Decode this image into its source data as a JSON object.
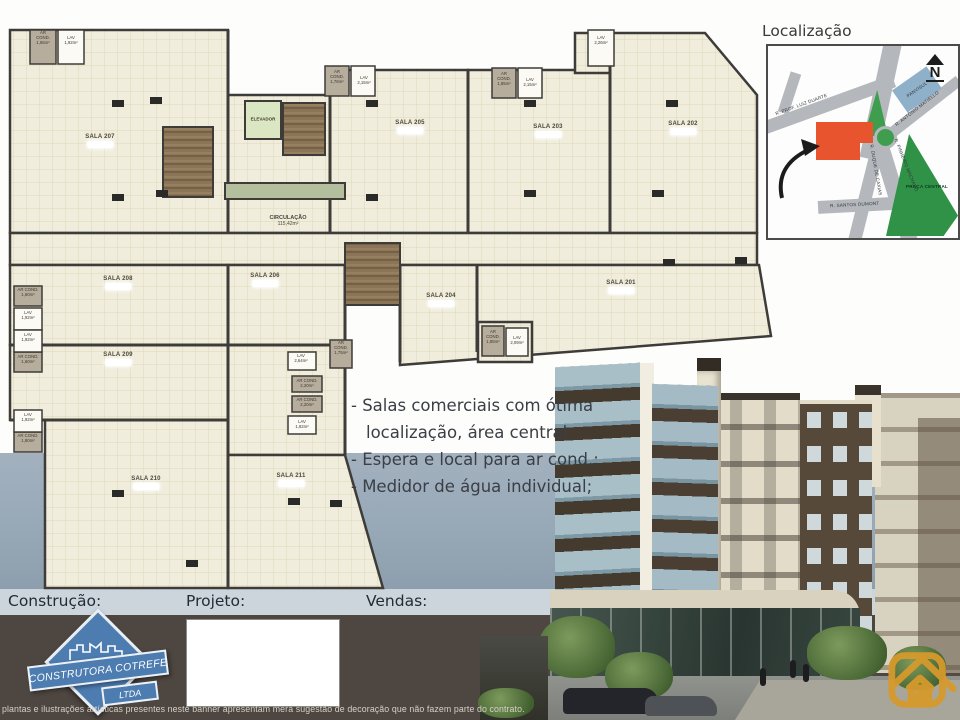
{
  "banner": {
    "bullets": [
      "- Salas comerciais com ótima",
      "localização, área central;",
      "- Espera e local para ar cond.;",
      "- Medidor de água individual;"
    ]
  },
  "plan": {
    "rooms": [
      {
        "label": "SALA 207"
      },
      {
        "label": "SALA 205"
      },
      {
        "label": "SALA 203"
      },
      {
        "label": "SALA 202"
      },
      {
        "label": "SALA 208"
      },
      {
        "label": "SALA 206"
      },
      {
        "label": "SALA 204"
      },
      {
        "label": "SALA 201"
      },
      {
        "label": "SALA 209"
      },
      {
        "label": "SALA 210"
      },
      {
        "label": "SALA 211"
      }
    ],
    "elevator_label": "ELEVADOR",
    "circulation_label": "CIRCULAÇÃO",
    "circulation_area": "115,42m²",
    "small_labels": [
      {
        "text": "AR\nCOND.\n1,65m²"
      },
      {
        "text": "LAV\n1,92m²"
      },
      {
        "text": "AR\nCOND.\n1,76m²"
      },
      {
        "text": "LAV\n2,15m²"
      },
      {
        "text": "AR\nCOND.\n1,85m²"
      },
      {
        "text": "LAV\n2,15m²"
      },
      {
        "text": "LAV\n2,26m²"
      },
      {
        "text": "AR COND.\n1,60m²"
      },
      {
        "text": "LAV\n1,92m²"
      },
      {
        "text": "LAV\n1,92m²"
      },
      {
        "text": "AR COND.\n1,60m²"
      },
      {
        "text": "LAV\n1,92m²"
      },
      {
        "text": "AR COND.\n1,80m²"
      },
      {
        "text": "LAV\n2,64m²"
      },
      {
        "text": "AR COND.\n2,20m²"
      },
      {
        "text": "AR COND.\n2,20m²"
      },
      {
        "text": "LAV\n1,92m²"
      },
      {
        "text": "AR\nCOND.\n1,75m²"
      },
      {
        "text": "AR\nCOND.\n1,85m²"
      },
      {
        "text": "LAV\n2,09m²"
      }
    ]
  },
  "location_map": {
    "title": "Localização",
    "north_label": "N",
    "streets": [
      {
        "name": "R. PROF. LUIZ DUARTE"
      },
      {
        "name": "R. ANTÔNIO MATIELLO"
      },
      {
        "name": "R. PINHEIRO MACHADO"
      },
      {
        "name": "R. DUQUE DE CAXIAS"
      },
      {
        "name": "R. SANTOS DUMONT"
      }
    ],
    "landmarks": [
      {
        "name": "PANVISUL"
      },
      {
        "name": "PRAÇA CENTRAL"
      }
    ]
  },
  "footer": {
    "construction_label": "Construção:",
    "project_label": "Projeto:",
    "sales_label": "Vendas:",
    "logo_line1": "CONSTRUTORA COTREFE",
    "logo_line2": "LTDA",
    "disclaimer": "plantas e ilustrações artísticas presentes neste banner apresentam mera sugestão de decoração que não fazem parte do contrato."
  },
  "colors": {
    "plan_fill": "#f0eddc",
    "wall": "#3e3c38",
    "stair_brown": "#8b7557",
    "elevator_green": "#dbe6c3",
    "street_band": "#9aaab8",
    "label_band": "#ccd5dc",
    "footer_brown": "#4e4640",
    "logo_blue": "#4c7cb0",
    "watermark_gold": "#d89a2b",
    "map_red": "#e8542e",
    "map_green": "#2f9247",
    "map_blue": "#8fb0c9",
    "map_road": "#b4b8bc"
  }
}
